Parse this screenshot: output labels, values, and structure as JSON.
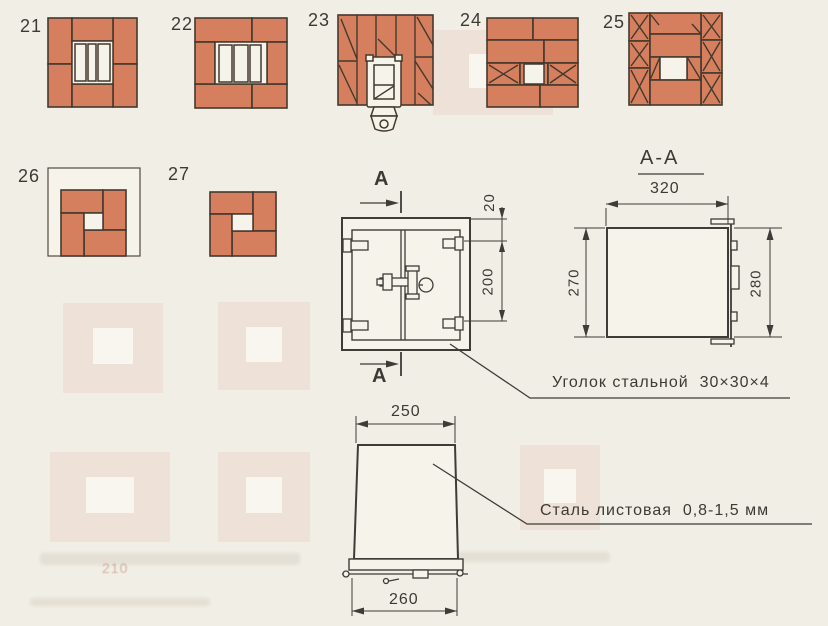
{
  "courses": [
    "21",
    "22",
    "23",
    "24",
    "25",
    "26",
    "27"
  ],
  "door": {
    "section_letter": "А",
    "dim_offset": "20",
    "dim_height": "200"
  },
  "section": {
    "title": "А-А",
    "dim_width": "320",
    "dim_frame": "270",
    "dim_door": "280"
  },
  "hood": {
    "dim_top": "250",
    "dim_bottom": "260"
  },
  "notes": {
    "angle": "Уголок стальной  30×30×4",
    "sheet": "Сталь листовая  0,8-1,5 мм"
  },
  "ghost_text": "210",
  "colors": {
    "brick": "#d57f5f",
    "line": "#44392d",
    "draw": "#3e3c38",
    "ink": "#3d3a35",
    "paper": "#f1eee5",
    "paper2": "#f6f3eb"
  }
}
